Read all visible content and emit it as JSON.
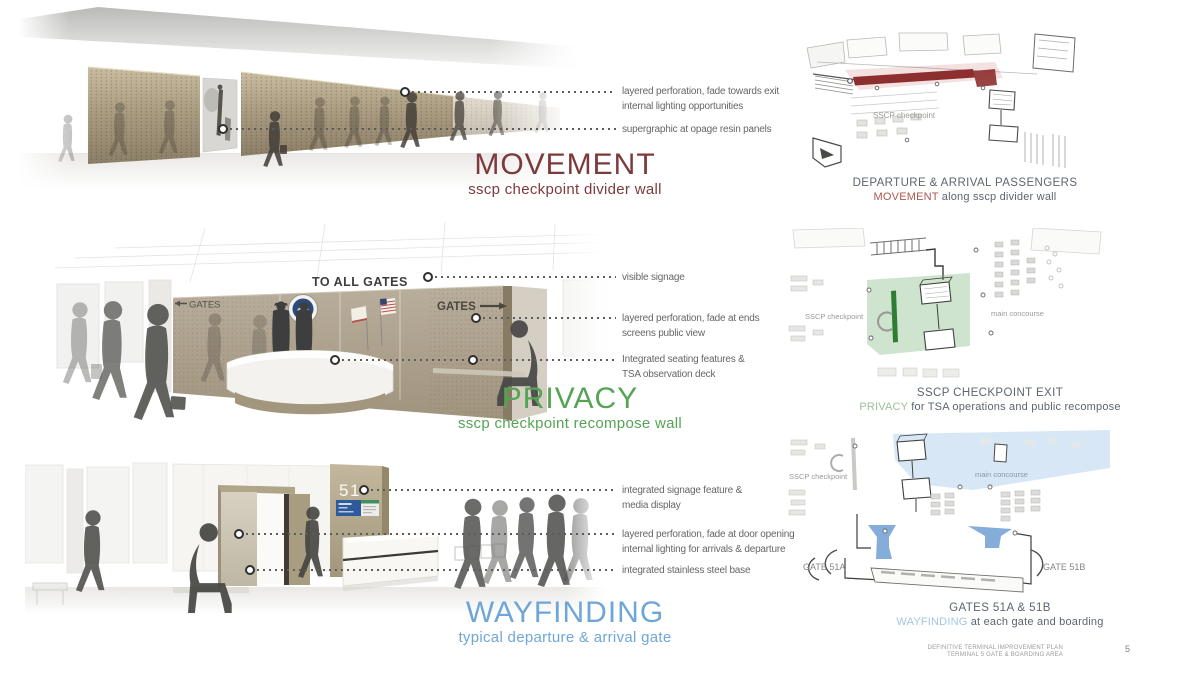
{
  "colors": {
    "movement": "#7d3a3c",
    "privacy": "#55a455",
    "wayfinding": "#6fa6d8"
  },
  "sections": {
    "movement": {
      "title": "MOVEMENT",
      "subtitle": "sscp checkpoint divider wall",
      "annotations": [
        {
          "line1": "layered perforation, fade towards exit",
          "line2": "internal lighting opportunities"
        },
        {
          "line1": "supergraphic at opage resin panels",
          "line2": ""
        }
      ],
      "plan": {
        "caption": "DEPARTURE & ARRIVAL PASSENGERS",
        "keyword": "MOVEMENT",
        "caption_rest": " along sscp divider wall",
        "label_checkpoint": "SSCP checkpoint"
      }
    },
    "privacy": {
      "title": "PRIVACY",
      "subtitle": "sscp checkpoint recompose wall",
      "render_labels": {
        "overhead_sign": "TO ALL GATES",
        "gates_left": "GATES",
        "gates_right": "GATES"
      },
      "annotations": [
        {
          "line1": "visible signage",
          "line2": ""
        },
        {
          "line1": "layered perforation, fade at ends",
          "line2": "screens public view"
        },
        {
          "line1": "Integrated seating features &",
          "line2": "TSA observation deck"
        }
      ],
      "plan": {
        "caption": "SSCP CHECKPOINT EXIT",
        "keyword": "PRIVACY",
        "caption_rest": " for TSA operations and public recompose",
        "label_checkpoint": "SSCP checkpoint",
        "label_concourse": "main concourse"
      }
    },
    "wayfinding": {
      "title": "WAYFINDING",
      "subtitle": "typical departure & arrival gate",
      "render_labels": {
        "gate_number": "51"
      },
      "annotations": [
        {
          "line1": "integrated signage feature &",
          "line2": "media display"
        },
        {
          "line1": "layered perforation, fade at door opening",
          "line2": "internal lighting for arrivals & departure"
        },
        {
          "line1": "integrated stainless steel base",
          "line2": ""
        }
      ],
      "plan": {
        "caption": "GATES 51A & 51B",
        "keyword": "WAYFINDING",
        "caption_rest": " at each gate and boarding",
        "label_checkpoint": "SSCP checkpoint",
        "label_concourse": "main concourse",
        "label_gate_a": "GATE 51A",
        "label_gate_b": "GATE 51B"
      }
    }
  },
  "footer": {
    "line1": "DEFINITIVE TERMINAL IMPROVEMENT PLAN",
    "line2": "TERMINAL 5  GATE & BOARDING AREA",
    "page_number": "5"
  }
}
